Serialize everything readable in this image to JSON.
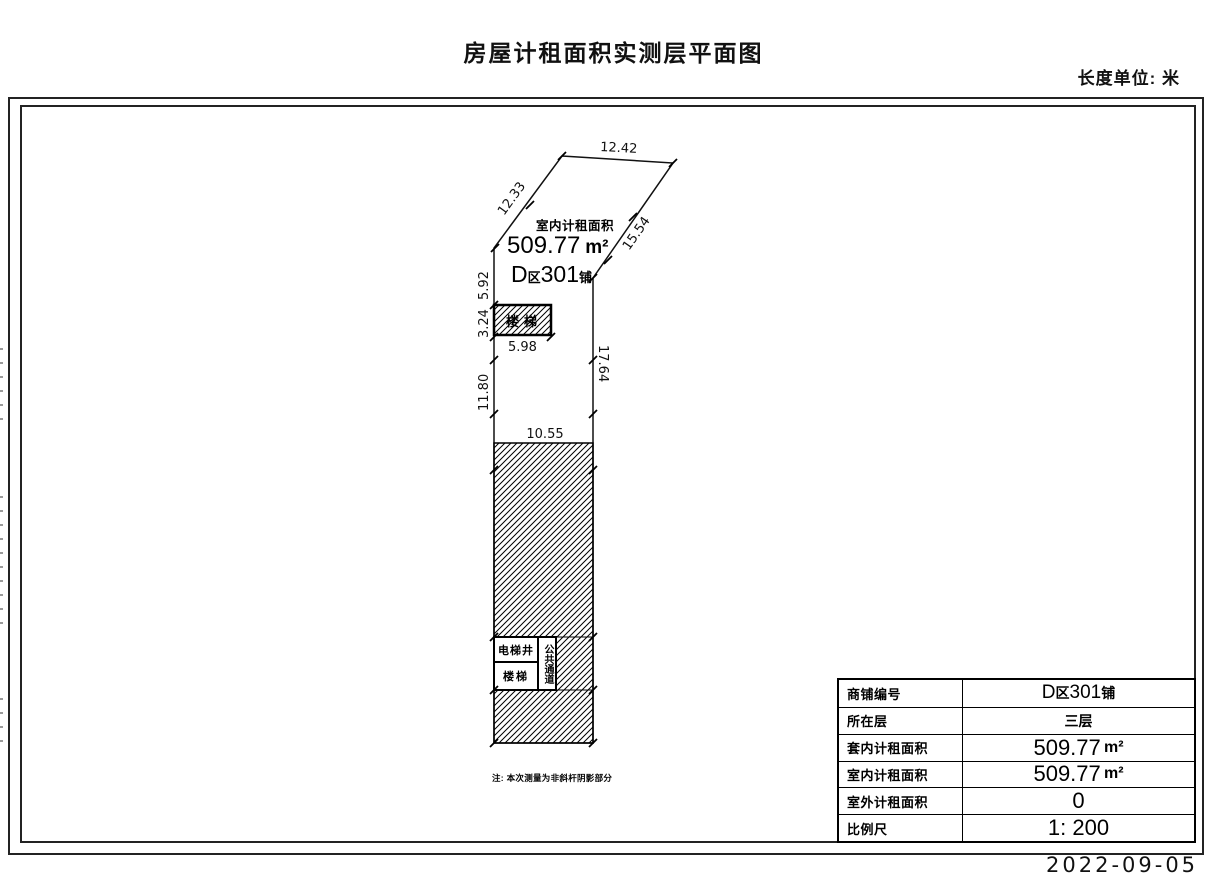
{
  "header": {
    "title": "房屋计租面积实测层平面图",
    "unit_label": "长度单位: 米"
  },
  "plan": {
    "area_title": "室内计租面积",
    "area_value": "509.77",
    "area_unit": "m²",
    "shop": {
      "letter": "D",
      "zone": "区",
      "number": "301",
      "suffix": "铺"
    },
    "dims": {
      "top_edge": "12.42",
      "left_diagonal": "12.33",
      "right_diagonal": "15.54",
      "left_upper": "5.92",
      "stair_height": "3.24",
      "stair_width": "5.98",
      "left_lower": "11.80",
      "right_vertical": "17.64",
      "hatch_width": "10.55"
    },
    "rooms": {
      "stair_top": "楼梯",
      "elevator_shaft": "电梯井",
      "stair_bottom": "楼梯",
      "public_passage": "公共通道"
    },
    "note": "注: 本次测量为非斜杆阴影部分"
  },
  "info_table": {
    "rows": [
      {
        "label": "商铺编号",
        "letter": "D",
        "zone": "区",
        "number": "301",
        "suffix": "铺"
      },
      {
        "label": "所在层",
        "value": "三层"
      },
      {
        "label": "套内计租面积",
        "value": "509.77",
        "unit": "m²"
      },
      {
        "label": "室内计租面积",
        "value": "509.77",
        "unit": "m²"
      },
      {
        "label": "室外计租面积",
        "value": "0"
      },
      {
        "label": "比例尺",
        "value": "1: 200"
      }
    ]
  },
  "footer": {
    "date": "2022-09-05"
  }
}
